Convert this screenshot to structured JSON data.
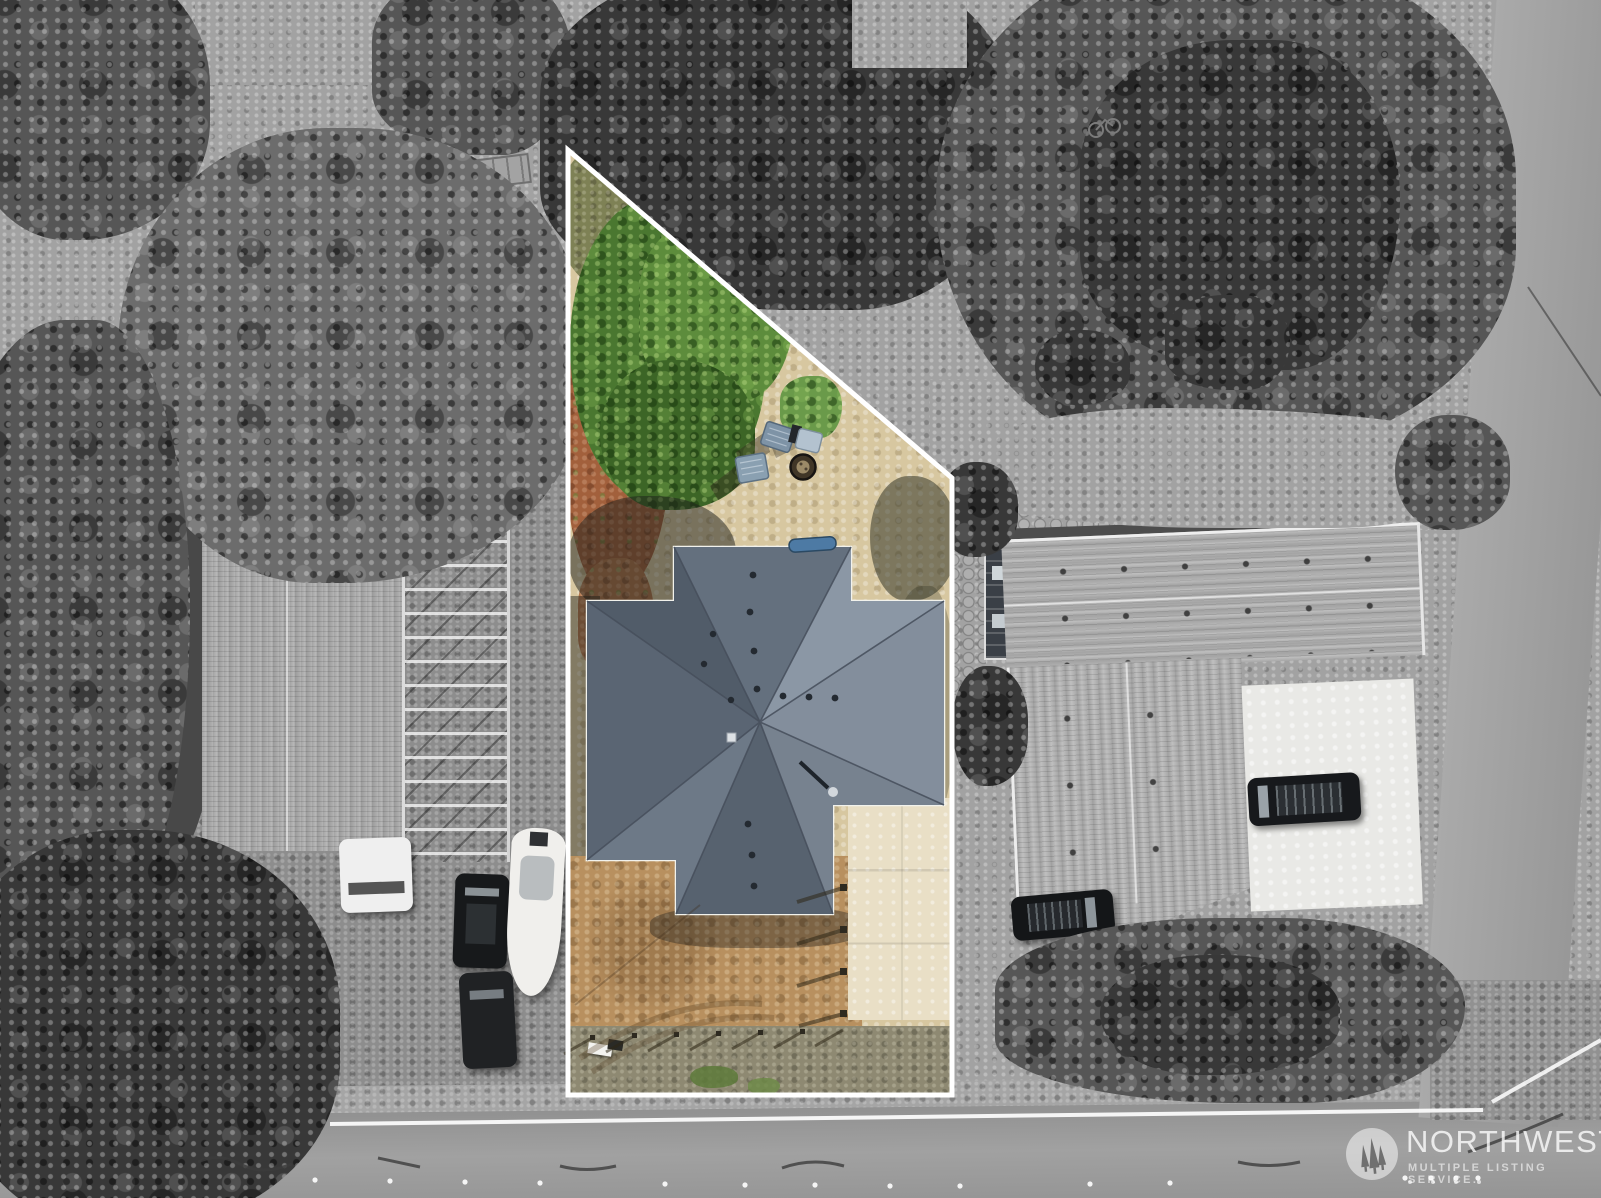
{
  "image": {
    "width_px": 1601,
    "height_px": 1198,
    "kind": "aerial drone photograph (real-estate listing)",
    "style": "subject parcel outlined in white and rendered in color; all surroundings desaturated to grayscale"
  },
  "subject_lot": {
    "outline_color": "#ffffff",
    "shape": "trapezoid with a diagonal tree-lined northeast boundary",
    "contents": [
      "cross-shaped hip roof with slate-blue shingles and roof vents",
      "green shrubs and small trees",
      "reddish-brown bare dirt patch",
      "tan sand yard",
      "two slate-blue adirondack chairs",
      "light folding chair",
      "round fire pit",
      "blue canoe beside house",
      "concrete patio slabs",
      "brown dirt driveway with tire tracks",
      "wood fence posts along driveway and road frontage",
      "small white gate"
    ]
  },
  "surroundings": {
    "left_property": [
      "large gray shingled outbuilding",
      "open lumber-rack framing",
      "white pickup truck carrying round speakers",
      "utility trailer with clutter",
      "white camper trailer",
      "white van",
      "dark SUV",
      "dark car",
      "white boat on trailer"
    ],
    "right_property": [
      "L-shaped gray shingled house",
      "dark shed",
      "paver-stone borders",
      "white concrete driveway",
      "dark SUV on driveway",
      "dark SUV near road",
      "white utility pad",
      "shrub hedge"
    ],
    "other": [
      "dense evergreen forest patches",
      "grass clearings",
      "circular paver patio at top edge",
      "wood boardwalk",
      "garden bench",
      "bicycle",
      "asphalt road along bottom with white edge line, tar-seam squiggles and reflective dots",
      "second road along the right edge with cable shadow"
    ]
  },
  "watermark": {
    "brand": "NORTHWEST",
    "tagline": "MULTIPLE LISTING SERVICE.",
    "logo": "three-pine-trees-in-circle",
    "dot_count": 4,
    "text_color": "rgba(255,255,255,0.75)"
  },
  "palette": {
    "grayscale_ground": "#969696",
    "grayscale_trees": "#4a4a4a",
    "asphalt": "#9c9c9c",
    "lot_sand": "#d7c7a0",
    "lot_red_dirt": "#a2603c",
    "lot_dirt_driveway": "#b8905f",
    "lot_gravel": "#8e8972",
    "bush_green": "#4a7730",
    "roof_slate_blue": "#6a7484",
    "concrete": "#e9dfc6",
    "chair_blue": "#7e93a6",
    "outline_white": "#ffffff"
  }
}
